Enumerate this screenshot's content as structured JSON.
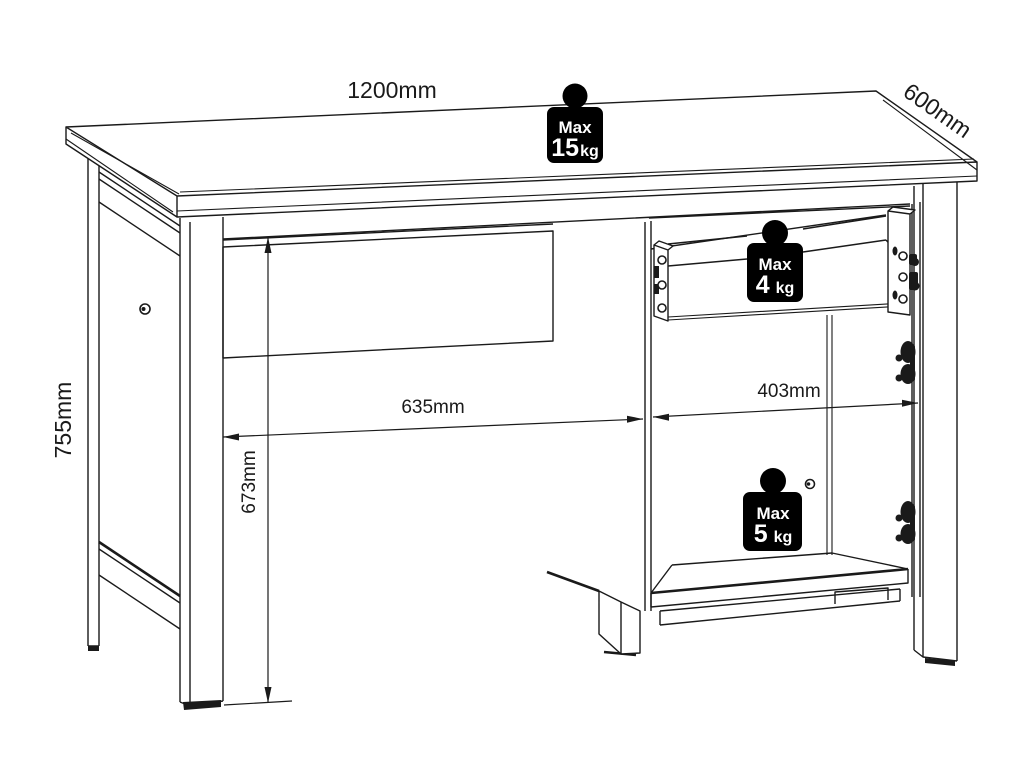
{
  "title": "Desk with drawer and cabinet - dimension diagram",
  "colors": {
    "line": "#1a1a1a",
    "background": "#ffffff",
    "badge_bg": "#000000",
    "badge_text": "#ffffff"
  },
  "dimensions": {
    "width_top": "1200mm",
    "depth": "600mm",
    "height": "755mm",
    "kneehole_width": "635mm",
    "cabinet_inner_width": "403mm",
    "kneehole_height": "673mm"
  },
  "load_badges": [
    {
      "label": "Max",
      "value": "15",
      "unit": "kg",
      "applies_to": "desktop"
    },
    {
      "label": "Max",
      "value": "4",
      "unit": "kg",
      "applies_to": "drawer"
    },
    {
      "label": "Max",
      "value": "5",
      "unit": "kg",
      "applies_to": "cabinet-shelf"
    }
  ]
}
